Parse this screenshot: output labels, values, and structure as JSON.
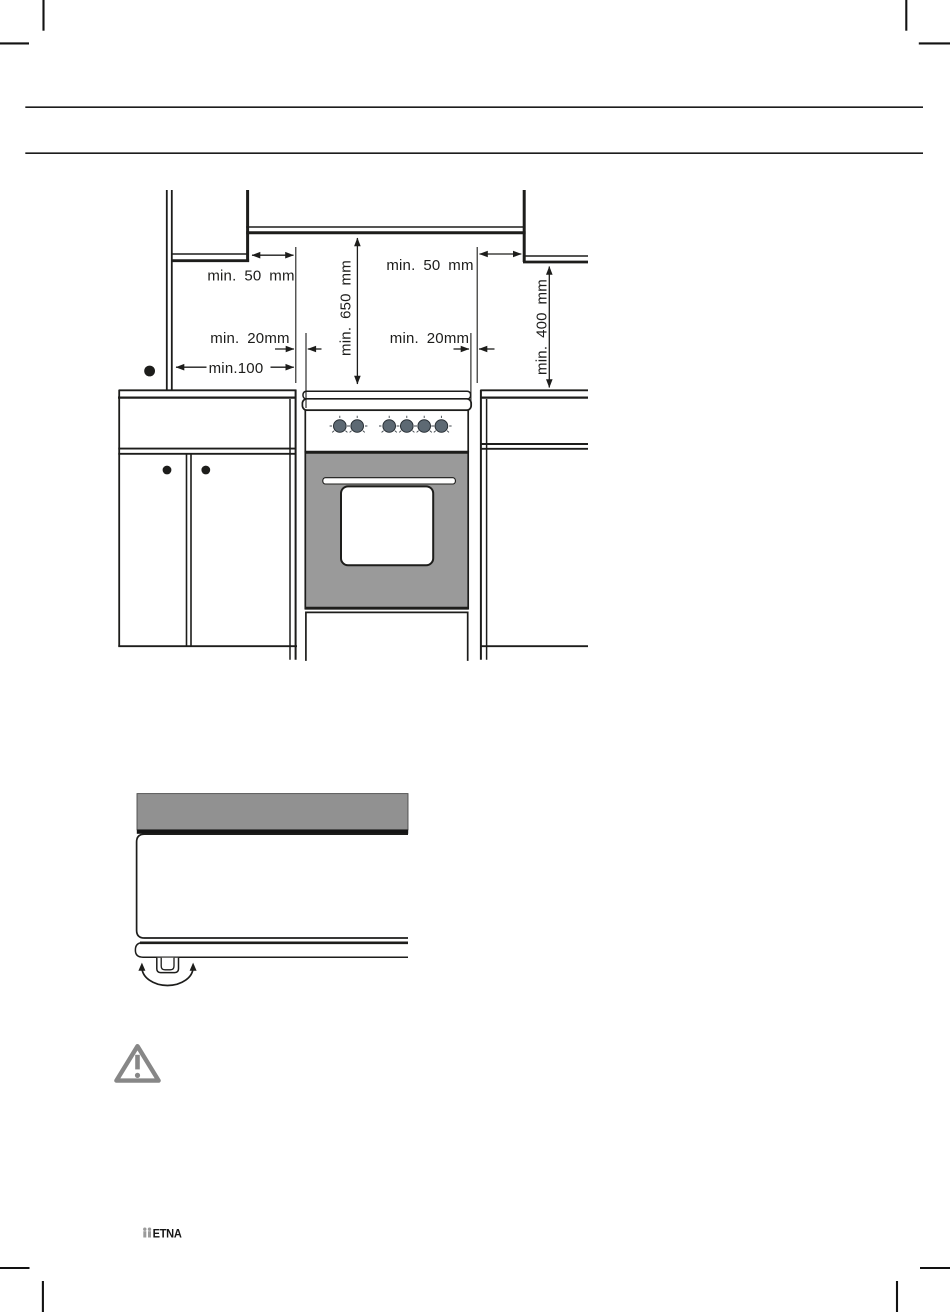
{
  "figure1": {
    "labels": {
      "min50_left": "min. 50 mm",
      "min650": "min. 650 mm",
      "min50_right": "min. 50 mm",
      "min400": "min. 400 mm",
      "min20_left": "min. 20mm",
      "min100": "min.100",
      "min20_right": "min. 20mm"
    },
    "knob_count": 6
  },
  "footer": {
    "brand": "ETNA"
  },
  "colors": {
    "diagram_line": "#1d1d1b",
    "oven_door_gray": "#9a9a9a",
    "appliance_band_gray": "#919191",
    "knob_gray": "#5d6973",
    "warning_icon_gray": "#878787",
    "logo_mark_gray": "#9b9b9b"
  }
}
